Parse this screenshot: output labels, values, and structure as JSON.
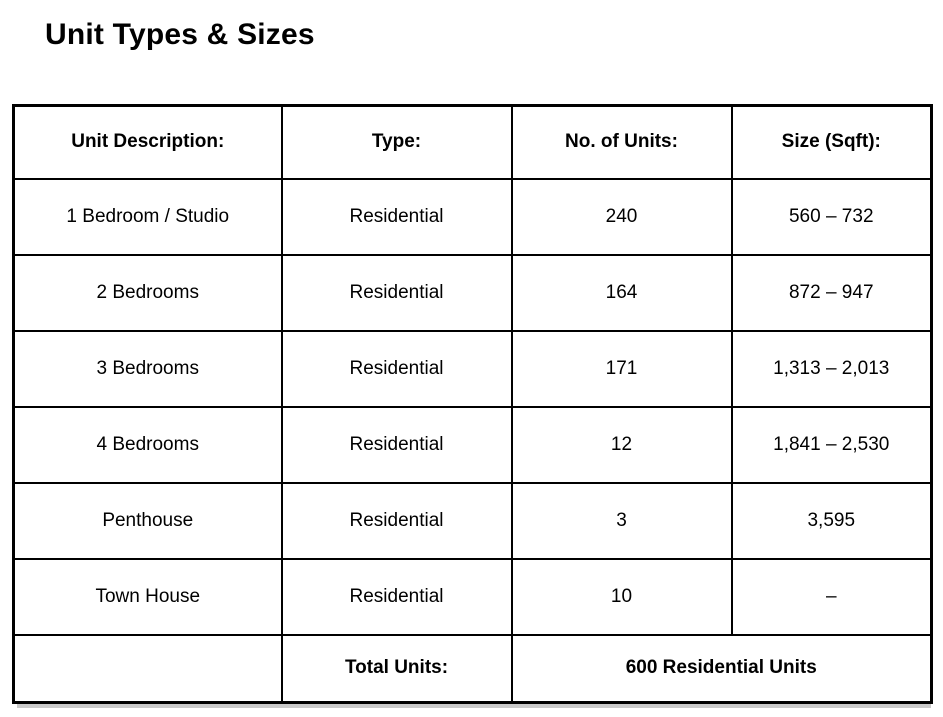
{
  "page": {
    "title": "Unit Types & Sizes"
  },
  "table": {
    "columns": {
      "description": "Unit Description:",
      "type": "Type:",
      "units": "No. of Units:",
      "size": "Size (Sqft):"
    },
    "rows": [
      {
        "description": "1 Bedroom / Studio",
        "type": "Residential",
        "units": "240",
        "size": "560 – 732"
      },
      {
        "description": "2 Bedrooms",
        "type": "Residential",
        "units": "164",
        "size": "872 – 947"
      },
      {
        "description": "3 Bedrooms",
        "type": "Residential",
        "units": "171",
        "size": "1,313 – 2,013"
      },
      {
        "description": "4 Bedrooms",
        "type": "Residential",
        "units": "12",
        "size": "1,841 – 2,530"
      },
      {
        "description": "Penthouse",
        "type": "Residential",
        "units": "3",
        "size": "3,595"
      },
      {
        "description": "Town House",
        "type": "Residential",
        "units": "10",
        "size": "–"
      }
    ],
    "footer": {
      "label": "Total Units:",
      "value": "600 Residential Units"
    }
  },
  "colors": {
    "text": "#000000",
    "border": "#000000",
    "background": "#ffffff",
    "shadow": "#c9c9c9"
  }
}
